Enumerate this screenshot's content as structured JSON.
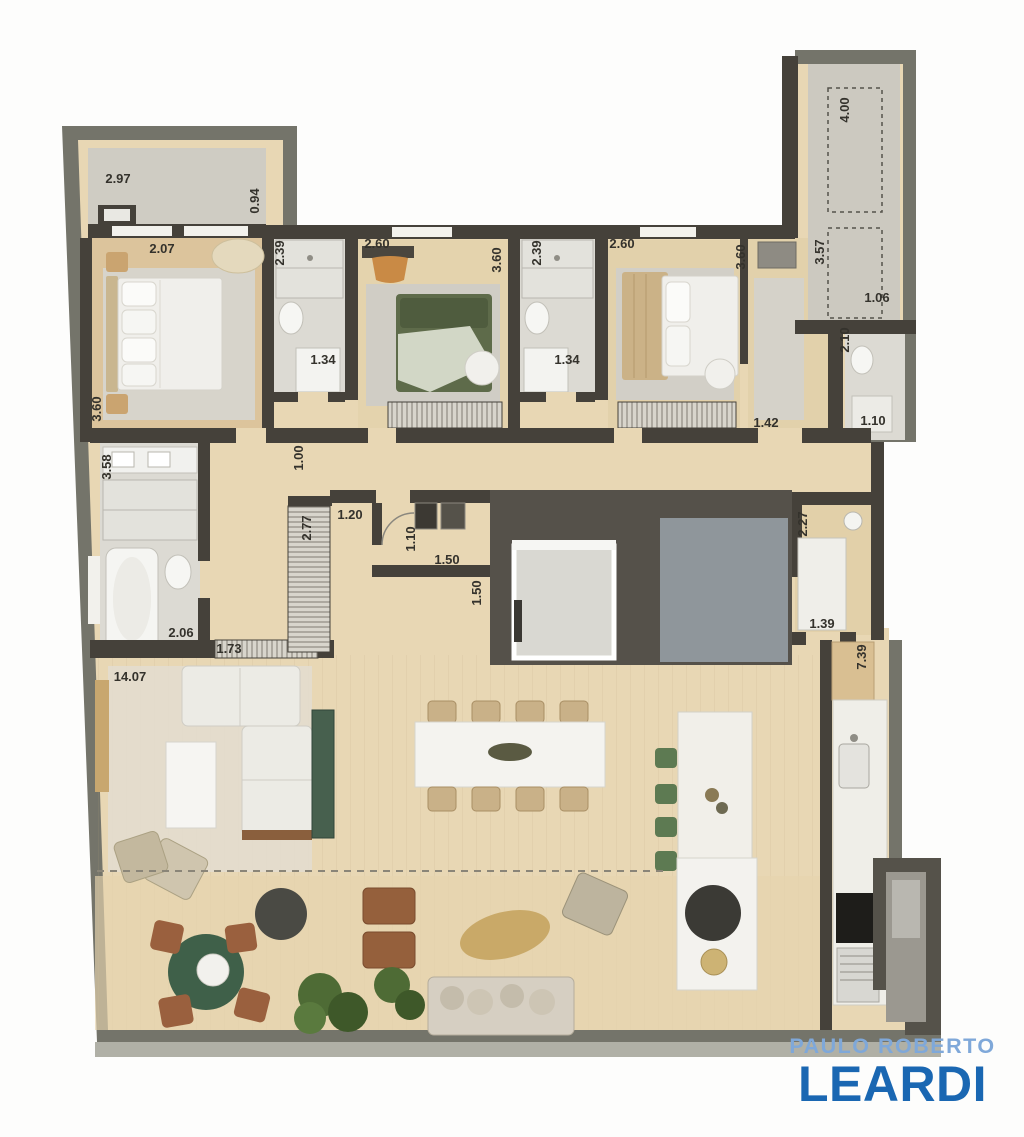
{
  "branding": {
    "line1": "PAULO ROBERTO",
    "line2": "LEARDI",
    "line1_color": "#7fa8d9",
    "line2_color": "#1a67b2"
  },
  "palette": {
    "outer_border": "#74746a",
    "interior_wall": "#45413a",
    "wood_floor": "#e8d7b4",
    "terrace_floor": "#e6d4ad",
    "bedroom_floor_tan": "#dcc49c",
    "rug_gray": "#d7d4cb",
    "bathroom_floor": "#dcdad3",
    "balcony_gray": "#cfccc3",
    "core_dark": "#55514a",
    "elevator_light": "#d9d8d2",
    "shaft_blue_gray": "#8f969b",
    "island_white": "#efeee8",
    "stool_green": "#5d7a52",
    "outdoor_chair_brown": "#9a603e",
    "plant_green": "#4e6b35",
    "green_marble": "#3f6049",
    "bed_green": "#5e6b4a"
  },
  "dims": [
    {
      "name": "balcony-width",
      "value": "2.97"
    },
    {
      "name": "balcony-depth",
      "value": "0.94"
    },
    {
      "name": "master-width",
      "value": "2.07"
    },
    {
      "name": "master-depth",
      "value": "3.60"
    },
    {
      "name": "bath1-depth",
      "value": "2.39"
    },
    {
      "name": "bath1-width",
      "value": "1.34"
    },
    {
      "name": "bedroom2-width",
      "value": "2.60"
    },
    {
      "name": "bedroom2-depth",
      "value": "3.60"
    },
    {
      "name": "bath2-depth",
      "value": "2.39"
    },
    {
      "name": "bath2-width",
      "value": "1.34"
    },
    {
      "name": "bedroom3-width",
      "value": "2.60"
    },
    {
      "name": "bedroom3-depth",
      "value": "3.60"
    },
    {
      "name": "closet-corridor-depth",
      "value": "3.57"
    },
    {
      "name": "tech-room-depth",
      "value": "4.00"
    },
    {
      "name": "bath-right-width",
      "value": "1.06"
    },
    {
      "name": "bath-right-depth",
      "value": "2.10"
    },
    {
      "name": "closet-opening",
      "value": "1.42"
    },
    {
      "name": "bath-right-door",
      "value": "1.10"
    },
    {
      "name": "bath-left-depth",
      "value": "3.58"
    },
    {
      "name": "bath-left-width",
      "value": "2.06"
    },
    {
      "name": "hall-cabinet",
      "value": "1.73"
    },
    {
      "name": "living-width",
      "value": "14.07"
    },
    {
      "name": "corridor-width",
      "value": "1.00"
    },
    {
      "name": "wardrobe-depth",
      "value": "2.77"
    },
    {
      "name": "corridor2-width",
      "value": "1.20"
    },
    {
      "name": "entry-width",
      "value": "1.10"
    },
    {
      "name": "entry-depth",
      "value": "1.50"
    },
    {
      "name": "elevator-side",
      "value": "1.50"
    },
    {
      "name": "pantry-depth",
      "value": "2.27"
    },
    {
      "name": "pantry-width",
      "value": "1.39"
    },
    {
      "name": "kitchen-run",
      "value": "7.39"
    }
  ]
}
